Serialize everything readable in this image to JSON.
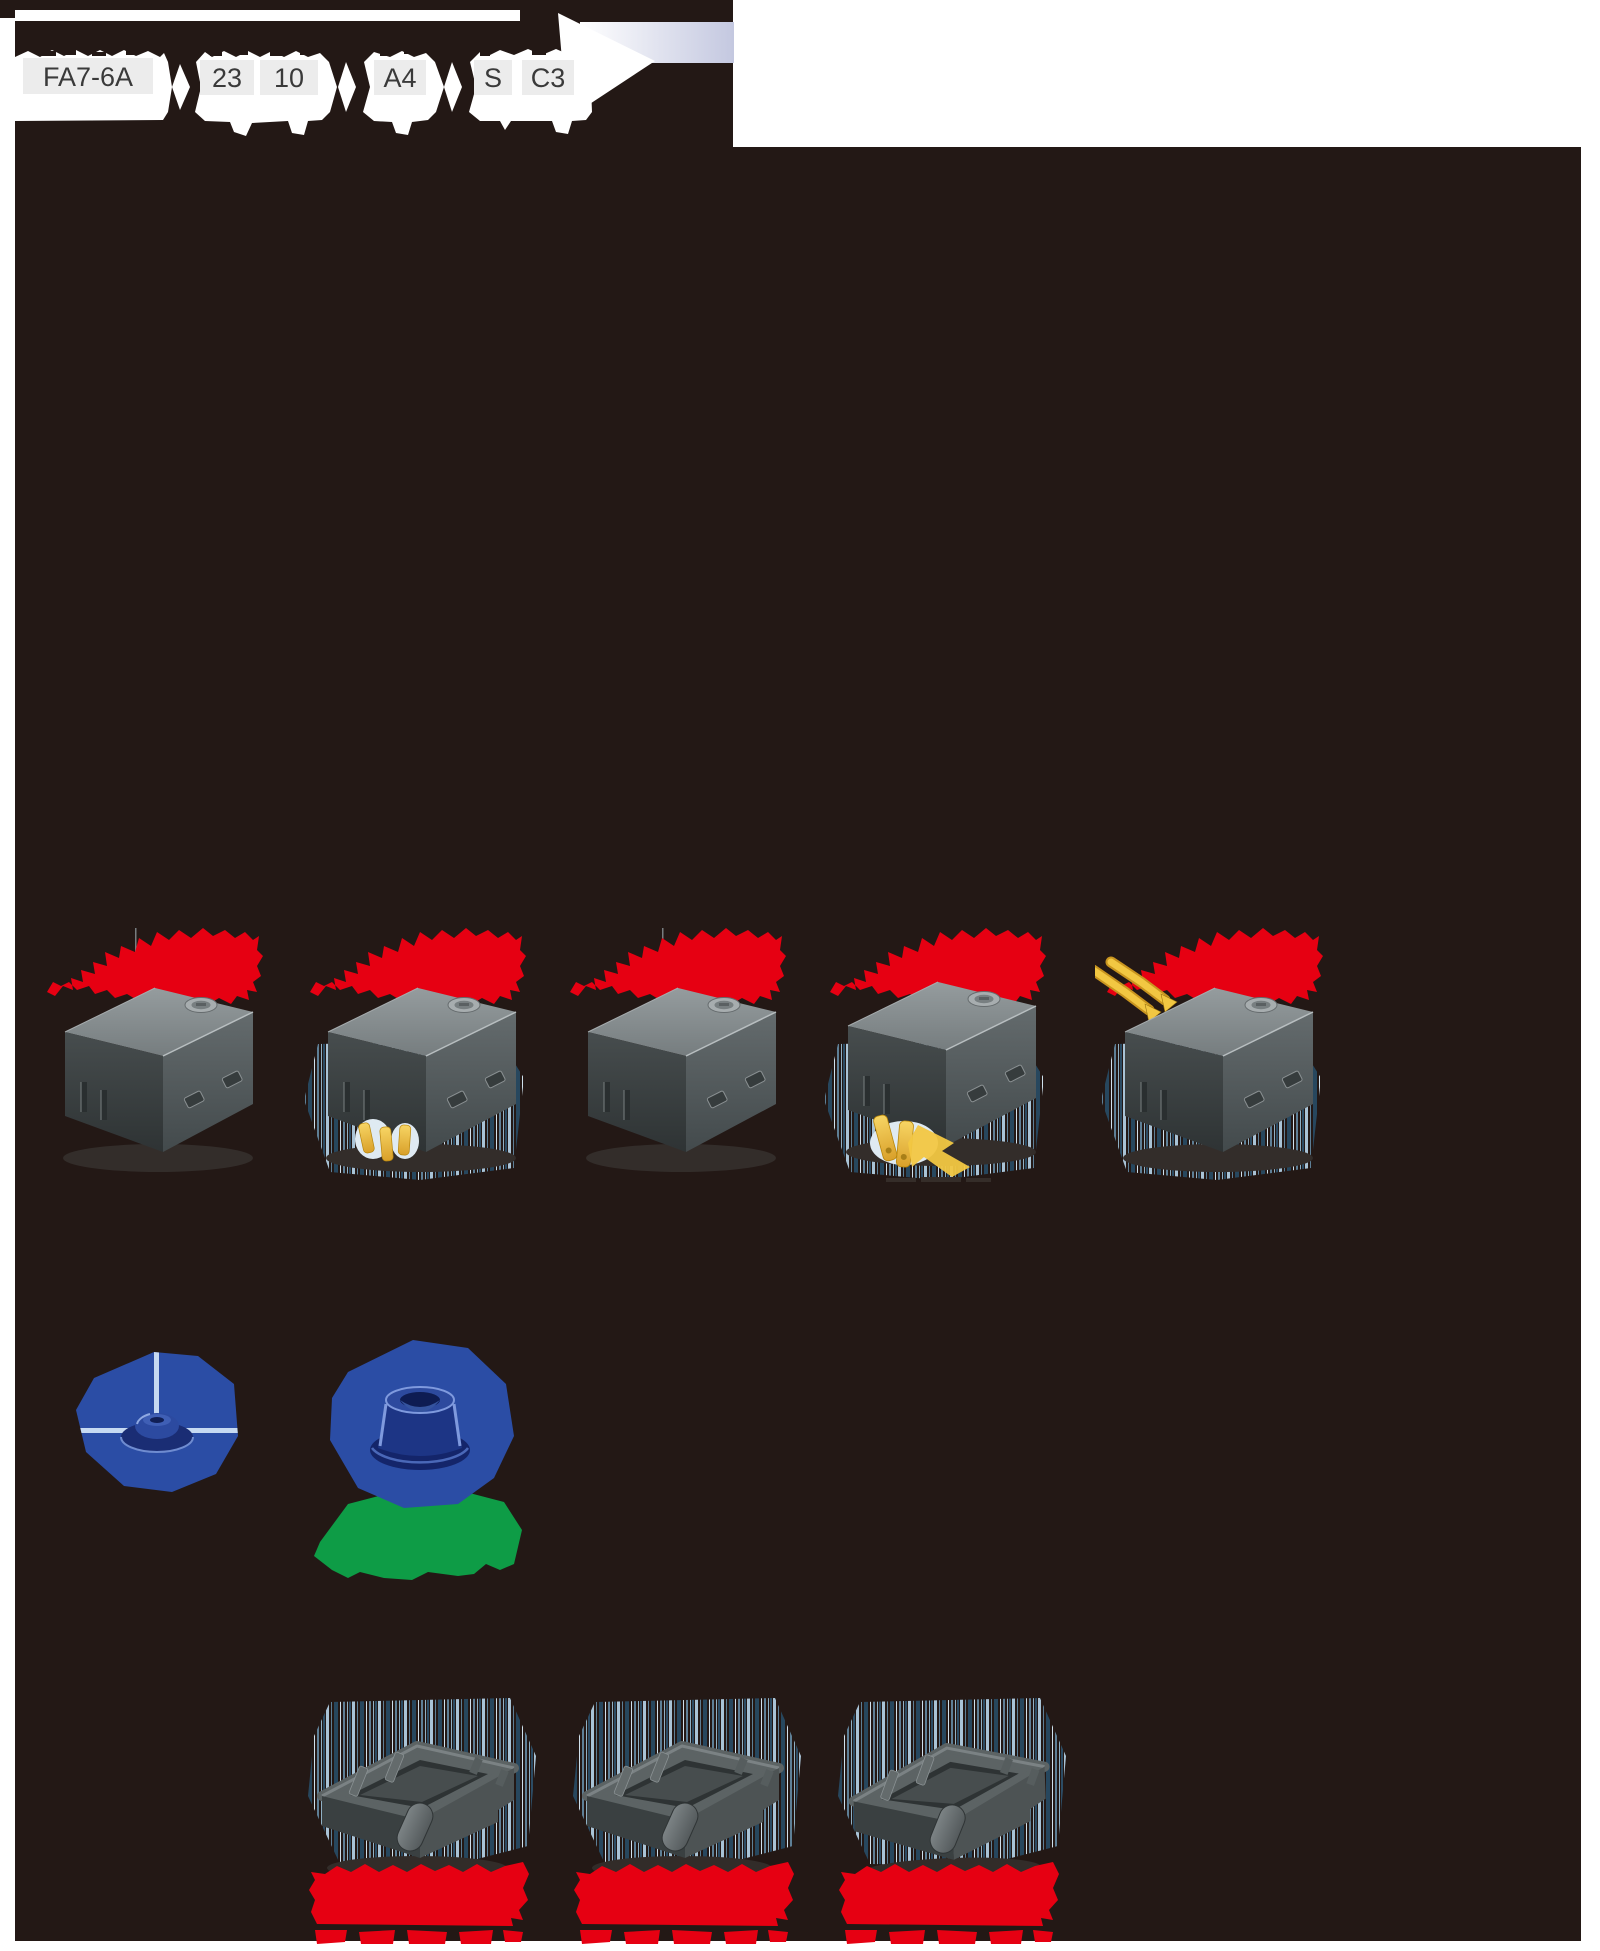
{
  "page": {
    "type": "catalog-product-figure",
    "description_visible_text_only": true
  },
  "colors": {
    "background": "#231815",
    "white": "#ffffff",
    "red": "#e60012",
    "blue": "#2b4da5",
    "blue_dark": "#16296b",
    "green": "#0e9c46",
    "yellow": "#f2c742",
    "lavender": "#c4c8e0",
    "hatch_light": "#aac4d8",
    "hatch_mid": "#5e7f96",
    "hatch_dark": "#27475e",
    "label_box": "#ececec",
    "label_text": "#3a3a3a",
    "gray_top": "#8d9496",
    "gray_front": "#575e60",
    "gray_side": "#3d4344"
  },
  "part_number_builder": {
    "segments": [
      {
        "label": "FA7-6A"
      },
      {
        "label": "23"
      },
      {
        "label": "10"
      },
      {
        "label": "A4"
      },
      {
        "label": "S"
      },
      {
        "label": "C3"
      }
    ]
  }
}
